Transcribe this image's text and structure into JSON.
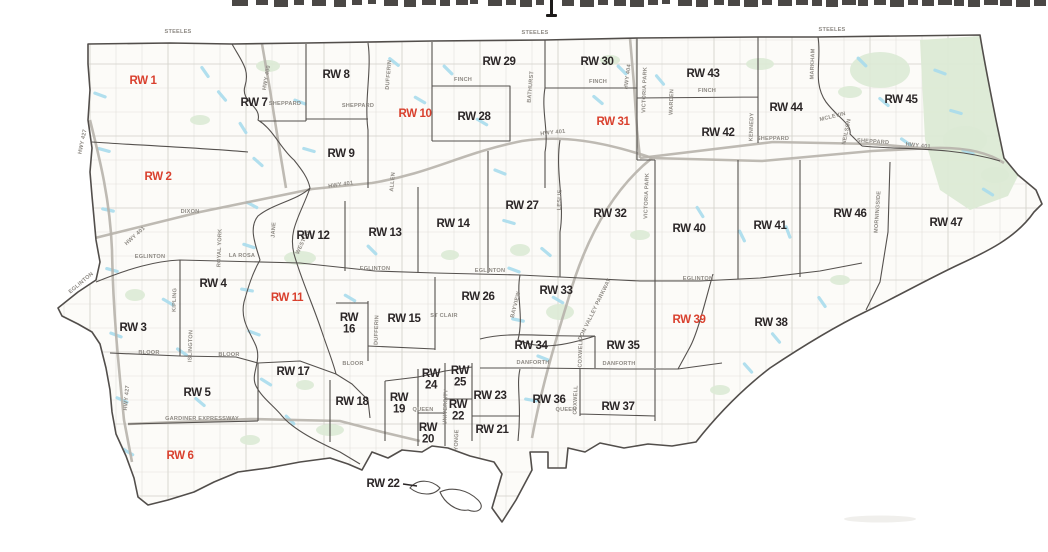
{
  "page": {
    "top_heading": {
      "text_legible": "",
      "state": "cropped-out-of-frame"
    }
  },
  "map": {
    "colors": {
      "ward_label_black": "#2b2627",
      "ward_label_red": "#d9402e",
      "road_label_gray": "#8e8a84",
      "boundary": "#55514e",
      "highway": "#b7b3ab",
      "water": "#a8dbec",
      "park": "#dcead5",
      "land": "#fcfbf8"
    },
    "wards": [
      {
        "label": "RW 1",
        "x": 143,
        "y": 80,
        "color": "red",
        "stacked": false
      },
      {
        "label": "RW 2",
        "x": 158,
        "y": 176,
        "color": "red",
        "stacked": false
      },
      {
        "label": "RW 3",
        "x": 133,
        "y": 327,
        "color": "black",
        "stacked": false
      },
      {
        "label": "RW 4",
        "x": 213,
        "y": 283,
        "color": "black",
        "stacked": false
      },
      {
        "label": "RW 5",
        "x": 197,
        "y": 392,
        "color": "black",
        "stacked": false
      },
      {
        "label": "RW 6",
        "x": 180,
        "y": 455,
        "color": "red",
        "stacked": false
      },
      {
        "label": "RW 7",
        "x": 254,
        "y": 102,
        "color": "black",
        "stacked": false
      },
      {
        "label": "RW 8",
        "x": 336,
        "y": 74,
        "color": "black",
        "stacked": false
      },
      {
        "label": "RW 9",
        "x": 341,
        "y": 153,
        "color": "black",
        "stacked": false
      },
      {
        "label": "RW 10",
        "x": 415,
        "y": 113,
        "color": "red",
        "stacked": false
      },
      {
        "label": "RW 11",
        "x": 287,
        "y": 297,
        "color": "red",
        "stacked": false
      },
      {
        "label": "RW 12",
        "x": 313,
        "y": 235,
        "color": "black",
        "stacked": false
      },
      {
        "label": "RW 13",
        "x": 385,
        "y": 232,
        "color": "black",
        "stacked": false
      },
      {
        "label": "RW 14",
        "x": 453,
        "y": 223,
        "color": "black",
        "stacked": false
      },
      {
        "label": "RW 15",
        "x": 404,
        "y": 318,
        "color": "black",
        "stacked": false
      },
      {
        "label": "RW 16",
        "x": 349,
        "y": 324,
        "color": "black",
        "stacked": true
      },
      {
        "label": "RW 17",
        "x": 293,
        "y": 371,
        "color": "black",
        "stacked": false
      },
      {
        "label": "RW 18",
        "x": 352,
        "y": 401,
        "color": "black",
        "stacked": false
      },
      {
        "label": "RW 19",
        "x": 399,
        "y": 404,
        "color": "black",
        "stacked": true
      },
      {
        "label": "RW 20",
        "x": 428,
        "y": 434,
        "color": "black",
        "stacked": true
      },
      {
        "label": "RW 21",
        "x": 492,
        "y": 429,
        "color": "black",
        "stacked": false
      },
      {
        "label": "RW 22",
        "x": 458,
        "y": 411,
        "color": "black",
        "stacked": true
      },
      {
        "label": "RW 23",
        "x": 490,
        "y": 395,
        "color": "black",
        "stacked": false
      },
      {
        "label": "RW 24",
        "x": 431,
        "y": 380,
        "color": "black",
        "stacked": true
      },
      {
        "label": "RW 25",
        "x": 460,
        "y": 377,
        "color": "black",
        "stacked": true
      },
      {
        "label": "RW 26",
        "x": 478,
        "y": 296,
        "color": "black",
        "stacked": false
      },
      {
        "label": "RW 27",
        "x": 522,
        "y": 205,
        "color": "black",
        "stacked": false
      },
      {
        "label": "RW 28",
        "x": 474,
        "y": 116,
        "color": "black",
        "stacked": false
      },
      {
        "label": "RW 29",
        "x": 499,
        "y": 61,
        "color": "black",
        "stacked": false
      },
      {
        "label": "RW 30",
        "x": 597,
        "y": 61,
        "color": "black",
        "stacked": false
      },
      {
        "label": "RW 31",
        "x": 613,
        "y": 121,
        "color": "red",
        "stacked": false
      },
      {
        "label": "RW 32",
        "x": 610,
        "y": 213,
        "color": "black",
        "stacked": false
      },
      {
        "label": "RW 33",
        "x": 556,
        "y": 290,
        "color": "black",
        "stacked": false
      },
      {
        "label": "RW 34",
        "x": 531,
        "y": 345,
        "color": "black",
        "stacked": false
      },
      {
        "label": "RW 35",
        "x": 623,
        "y": 345,
        "color": "black",
        "stacked": false
      },
      {
        "label": "RW 36",
        "x": 549,
        "y": 399,
        "color": "black",
        "stacked": false
      },
      {
        "label": "RW 37",
        "x": 618,
        "y": 406,
        "color": "black",
        "stacked": false
      },
      {
        "label": "RW 38",
        "x": 771,
        "y": 322,
        "color": "black",
        "stacked": false
      },
      {
        "label": "RW 39",
        "x": 689,
        "y": 319,
        "color": "red",
        "stacked": false
      },
      {
        "label": "RW 40",
        "x": 689,
        "y": 228,
        "color": "black",
        "stacked": false
      },
      {
        "label": "RW 41",
        "x": 770,
        "y": 225,
        "color": "black",
        "stacked": false
      },
      {
        "label": "RW 42",
        "x": 718,
        "y": 132,
        "color": "black",
        "stacked": false
      },
      {
        "label": "RW 43",
        "x": 703,
        "y": 73,
        "color": "black",
        "stacked": false
      },
      {
        "label": "RW 44",
        "x": 786,
        "y": 107,
        "color": "black",
        "stacked": false
      },
      {
        "label": "RW 45",
        "x": 901,
        "y": 99,
        "color": "black",
        "stacked": false
      },
      {
        "label": "RW 46",
        "x": 850,
        "y": 213,
        "color": "black",
        "stacked": false
      },
      {
        "label": "RW 47",
        "x": 946,
        "y": 222,
        "color": "black",
        "stacked": false
      }
    ],
    "islands_callout": {
      "label": "RW 22",
      "x": 383,
      "y": 483
    },
    "roads": [
      {
        "label": "STEELES",
        "x": 178,
        "y": 33,
        "rot": 0
      },
      {
        "label": "STEELES",
        "x": 535,
        "y": 34,
        "rot": 0
      },
      {
        "label": "STEELES",
        "x": 832,
        "y": 31,
        "rot": 0
      },
      {
        "label": "HWY 427",
        "x": 84,
        "y": 142,
        "rot": -78
      },
      {
        "label": "HWY 427",
        "x": 128,
        "y": 398,
        "rot": -85
      },
      {
        "label": "HWY 400",
        "x": 268,
        "y": 78,
        "rot": -80
      },
      {
        "label": "HWY 401",
        "x": 341,
        "y": 186,
        "rot": -8
      },
      {
        "label": "HWY 401",
        "x": 136,
        "y": 237,
        "rot": -42
      },
      {
        "label": "HWY 401",
        "x": 553,
        "y": 134,
        "rot": -6
      },
      {
        "label": "HWY 401",
        "x": 918,
        "y": 147,
        "rot": 6
      },
      {
        "label": "HWY 404",
        "x": 629,
        "y": 77,
        "rot": -82
      },
      {
        "label": "FINCH",
        "x": 463,
        "y": 81,
        "rot": 0
      },
      {
        "label": "FINCH",
        "x": 598,
        "y": 83,
        "rot": 0
      },
      {
        "label": "FINCH",
        "x": 707,
        "y": 92,
        "rot": 0
      },
      {
        "label": "SHEPPARD",
        "x": 285,
        "y": 105,
        "rot": 0
      },
      {
        "label": "SHEPPARD",
        "x": 358,
        "y": 107,
        "rot": 0
      },
      {
        "label": "SHEPPARD",
        "x": 773,
        "y": 140,
        "rot": 0
      },
      {
        "label": "SHEPPARD",
        "x": 873,
        "y": 143,
        "rot": 4
      },
      {
        "label": "EGLINTON",
        "x": 150,
        "y": 258,
        "rot": 0
      },
      {
        "label": "EGLINTON",
        "x": 375,
        "y": 270,
        "rot": 0
      },
      {
        "label": "EGLINTON",
        "x": 490,
        "y": 272,
        "rot": 0
      },
      {
        "label": "EGLINTON",
        "x": 698,
        "y": 280,
        "rot": 0
      },
      {
        "label": "EGLINTON",
        "x": 82,
        "y": 284,
        "rot": -40
      },
      {
        "label": "ST CLAIR",
        "x": 444,
        "y": 317,
        "rot": 0
      },
      {
        "label": "BLOOR",
        "x": 149,
        "y": 354,
        "rot": 0
      },
      {
        "label": "BLOOR",
        "x": 229,
        "y": 356,
        "rot": 0
      },
      {
        "label": "BLOOR",
        "x": 353,
        "y": 365,
        "rot": 0
      },
      {
        "label": "DANFORTH",
        "x": 533,
        "y": 364,
        "rot": 0
      },
      {
        "label": "DANFORTH",
        "x": 619,
        "y": 365,
        "rot": 0
      },
      {
        "label": "QUEEN",
        "x": 423,
        "y": 411,
        "rot": 0
      },
      {
        "label": "QUEEN",
        "x": 566,
        "y": 411,
        "rot": 0
      },
      {
        "label": "GARDINER EXPRESSWAY",
        "x": 202,
        "y": 420,
        "rot": 0
      },
      {
        "label": "DIXON",
        "x": 190,
        "y": 213,
        "rot": 0
      },
      {
        "label": "LA ROSA",
        "x": 242,
        "y": 257,
        "rot": 0
      },
      {
        "label": "DUFFERIN",
        "x": 390,
        "y": 75,
        "rot": -85
      },
      {
        "label": "DUFFERIN",
        "x": 378,
        "y": 330,
        "rot": -88
      },
      {
        "label": "BATHURST",
        "x": 532,
        "y": 87,
        "rot": -85
      },
      {
        "label": "VICTORIA PARK",
        "x": 646,
        "y": 90,
        "rot": -88
      },
      {
        "label": "VICTORIA PARK",
        "x": 648,
        "y": 196,
        "rot": -88
      },
      {
        "label": "WARDEN",
        "x": 673,
        "y": 102,
        "rot": -88
      },
      {
        "label": "KENNEDY",
        "x": 753,
        "y": 127,
        "rot": -88
      },
      {
        "label": "MARKHAM",
        "x": 814,
        "y": 64,
        "rot": -88
      },
      {
        "label": "NEILSON",
        "x": 848,
        "y": 132,
        "rot": -78
      },
      {
        "label": "MCLEVIN",
        "x": 833,
        "y": 118,
        "rot": -14
      },
      {
        "label": "MORNINGSIDE",
        "x": 879,
        "y": 212,
        "rot": -86
      },
      {
        "label": "KIPLING",
        "x": 176,
        "y": 300,
        "rot": -88
      },
      {
        "label": "ISLINGTON",
        "x": 192,
        "y": 346,
        "rot": -88
      },
      {
        "label": "ROYAL YORK",
        "x": 221,
        "y": 248,
        "rot": -88
      },
      {
        "label": "JANE",
        "x": 275,
        "y": 230,
        "rot": -86
      },
      {
        "label": "WESTON",
        "x": 304,
        "y": 243,
        "rot": -65
      },
      {
        "label": "ALLEN",
        "x": 394,
        "y": 182,
        "rot": -85
      },
      {
        "label": "LESLIE",
        "x": 561,
        "y": 200,
        "rot": -88
      },
      {
        "label": "BAYVIEW",
        "x": 517,
        "y": 305,
        "rot": -76
      },
      {
        "label": "DON VALLEY PARKWAY",
        "x": 596,
        "y": 310,
        "rot": -64
      },
      {
        "label": "COXWELL",
        "x": 582,
        "y": 353,
        "rot": -88
      },
      {
        "label": "COXWELL",
        "x": 577,
        "y": 400,
        "rot": -88
      },
      {
        "label": "YONGE",
        "x": 458,
        "y": 440,
        "rot": -88
      },
      {
        "label": "UNIVERSITY",
        "x": 447,
        "y": 407,
        "rot": -88
      }
    ]
  }
}
